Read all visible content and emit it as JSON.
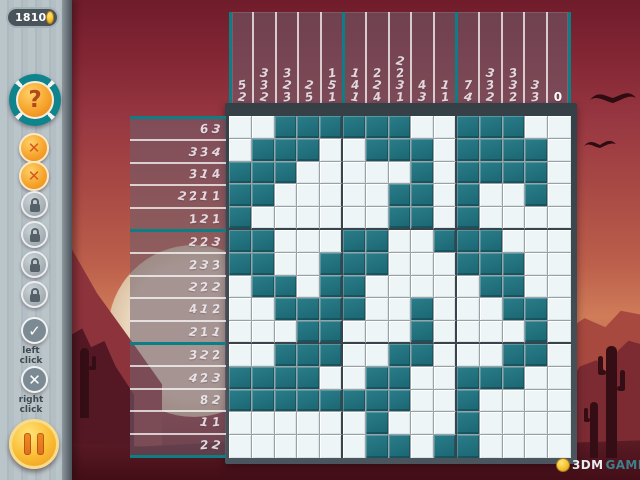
{
  "hud": {
    "coins": "1810",
    "hint_label": "?",
    "undo_label": "✕",
    "check_label": "✓",
    "cross_label": "✕",
    "left_click_line1": "left",
    "left_click_line2": "click",
    "right_click_line1": "right",
    "right_click_line2": "click"
  },
  "watermark": {
    "brand_3dm": "3DM",
    "brand_game": "GAME"
  },
  "puzzle": {
    "size": 15,
    "row_clues": [
      [
        6,
        3
      ],
      [
        3,
        3,
        4
      ],
      [
        3,
        1,
        4
      ],
      [
        2,
        2,
        1,
        1
      ],
      [
        1,
        2,
        1
      ],
      [
        2,
        2,
        3
      ],
      [
        2,
        3,
        3
      ],
      [
        2,
        2,
        2
      ],
      [
        4,
        1,
        2
      ],
      [
        2,
        1,
        1
      ],
      [
        3,
        2,
        2
      ],
      [
        4,
        2,
        3
      ],
      [
        8,
        2
      ],
      [
        1,
        1
      ],
      [
        2,
        2
      ]
    ],
    "col_clues": [
      [
        5,
        2
      ],
      [
        3,
        3,
        2
      ],
      [
        3,
        2,
        3
      ],
      [
        2,
        5
      ],
      [
        1,
        5,
        1
      ],
      [
        1,
        4,
        1
      ],
      [
        2,
        2,
        4
      ],
      [
        2,
        2,
        3,
        1
      ],
      [
        4,
        3
      ],
      [
        1,
        1
      ],
      [
        7,
        4
      ],
      [
        3,
        3,
        2
      ],
      [
        3,
        3,
        2
      ],
      [
        3,
        3
      ],
      [
        0
      ]
    ],
    "grid": [
      "001111110011100",
      "011100111011110",
      "111000001011110",
      "110000011010010",
      "100000011010000",
      "110001100111000",
      "110011100011100",
      "011011000001100",
      "001111001000110",
      "000110001000010",
      "001110011000110",
      "111100110011100",
      "111111110010000",
      "000000100010000",
      "000000110110000"
    ]
  },
  "colors": {
    "cell_filled": "#1f6e7c",
    "cell_empty": "#eef5f6",
    "group_line": "#0c7e86",
    "clue_text": "#f2ecf2",
    "panel_tint": "rgba(109,95,110,0.55)",
    "sky_top": "#6f1c2b",
    "ground": "#430e17",
    "coin_gold": "#f4c430"
  },
  "icons": [
    "coin-icon",
    "question-icon",
    "x-icon",
    "lock-icon",
    "check-icon",
    "pause-icon",
    "bird-icon",
    "cactus-icon",
    "sun-icon"
  ]
}
